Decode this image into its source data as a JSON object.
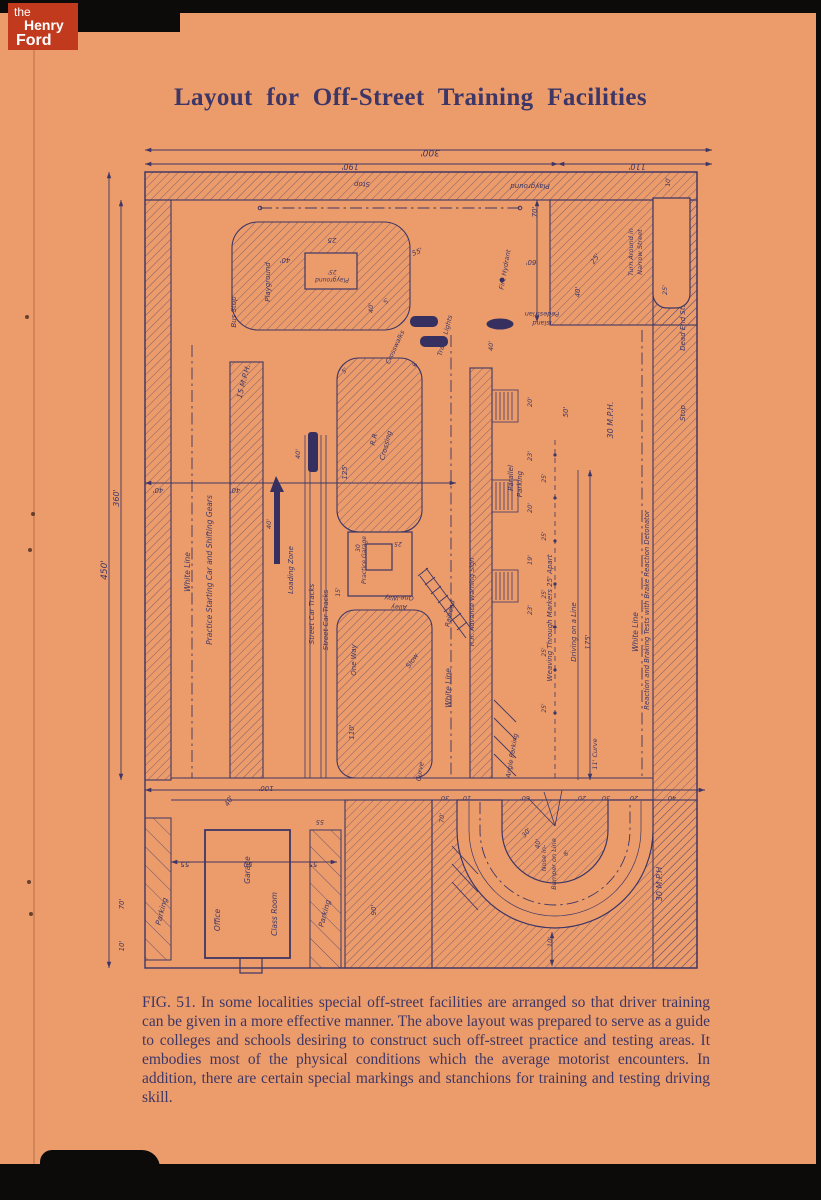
{
  "colors": {
    "paper": "#ec9c6a",
    "ink": "#3d3666",
    "logo_red": "#c23a1e",
    "frame": "#0c0b09"
  },
  "logo": {
    "line1": "the",
    "line2": "Henry",
    "line3": "Ford"
  },
  "title": "Layout for Off-Street Training Facilities",
  "caption": "FIG. 51. In some localities special off-street facilities are arranged so that driver training can be given in a more effective manner.  The above layout was prepared to serve as a guide to colleges and schools desiring to construct such off-street practice and testing areas.  It embodies most of the physical conditions which the average motorist encounters.  In addition, there are certain special markings and stanchions for training and testing driving skill.",
  "diagram": {
    "description": "Blueprint site plan of an off-street driver training facility",
    "labels": [
      {
        "t": "300'",
        "x": 330,
        "y": 10,
        "r": 180,
        "s": 9
      },
      {
        "t": "190'",
        "x": 250,
        "y": 24,
        "r": 180,
        "s": 8
      },
      {
        "t": "110'",
        "x": 537,
        "y": 24,
        "r": 180,
        "s": 8
      },
      {
        "t": "450'",
        "x": 7,
        "y": 430,
        "r": -90,
        "s": 9
      },
      {
        "t": "360'",
        "x": 19,
        "y": 358,
        "r": -90,
        "s": 8
      },
      {
        "t": "Stop",
        "x": 262,
        "y": 42,
        "r": 180,
        "s": 7
      },
      {
        "t": "Playground",
        "x": 430,
        "y": 44,
        "r": 180,
        "s": 7
      },
      {
        "t": "Playground",
        "x": 170,
        "y": 142,
        "r": -90,
        "s": 7
      },
      {
        "t": "Playground",
        "x": 232,
        "y": 138,
        "r": 180,
        "s": 6
      },
      {
        "t": "25'",
        "x": 232,
        "y": 130,
        "r": 180,
        "s": 6
      },
      {
        "t": "25",
        "x": 232,
        "y": 98,
        "r": 180,
        "s": 7
      },
      {
        "t": "40'",
        "x": 185,
        "y": 118,
        "r": 180,
        "s": 7
      },
      {
        "t": "55'",
        "x": 318,
        "y": 114,
        "r": -20,
        "s": 7
      },
      {
        "t": "Bus Stop",
        "x": 136,
        "y": 172,
        "r": -90,
        "s": 7
      },
      {
        "t": "Turn Around in",
        "x": 533,
        "y": 112,
        "r": -90,
        "s": 6.5
      },
      {
        "t": "Narrow Street",
        "x": 542,
        "y": 112,
        "r": -90,
        "s": 6.5
      },
      {
        "t": "10'",
        "x": 570,
        "y": 42,
        "r": -90,
        "s": 6
      },
      {
        "t": "25'",
        "x": 567,
        "y": 150,
        "r": -90,
        "s": 6.5
      },
      {
        "t": "Dead End St.",
        "x": 585,
        "y": 188,
        "r": -90,
        "s": 7
      },
      {
        "t": "Stop",
        "x": 585,
        "y": 273,
        "r": -90,
        "s": 7
      },
      {
        "t": "70'",
        "x": 437,
        "y": 72,
        "r": -90,
        "s": 7
      },
      {
        "t": "60'",
        "x": 431,
        "y": 120,
        "r": 180,
        "s": 7
      },
      {
        "t": "25'",
        "x": 497,
        "y": 120,
        "r": -55,
        "s": 7
      },
      {
        "t": "Fire Hydrant",
        "x": 407,
        "y": 130,
        "r": -80,
        "s": 6.5
      },
      {
        "t": "Crosswalks",
        "x": 297,
        "y": 208,
        "r": -65,
        "s": 6.5
      },
      {
        "t": "Traffic Lights",
        "x": 347,
        "y": 196,
        "r": -75,
        "s": 6.5
      },
      {
        "t": "Pedestrian",
        "x": 442,
        "y": 172,
        "r": 180,
        "s": 6.5
      },
      {
        "t": "Island",
        "x": 442,
        "y": 181,
        "r": 180,
        "s": 6.5
      },
      {
        "t": "5'",
        "x": 288,
        "y": 162,
        "r": -60,
        "s": 6
      },
      {
        "t": "6'",
        "x": 317,
        "y": 224,
        "r": -90,
        "s": 6
      },
      {
        "t": "40'",
        "x": 273,
        "y": 168,
        "r": -90,
        "s": 6.5
      },
      {
        "t": "40'",
        "x": 393,
        "y": 206,
        "r": -90,
        "s": 6.5
      },
      {
        "t": "15 M.P.H.",
        "x": 146,
        "y": 242,
        "r": -75,
        "s": 7.5
      },
      {
        "t": "White Line",
        "x": 90,
        "y": 432,
        "r": -90,
        "s": 7.5
      },
      {
        "t": "Practice Starting Car and Shifting Gears",
        "x": 112,
        "y": 430,
        "r": -90,
        "s": 7.5
      },
      {
        "t": "Loading Zone",
        "x": 193,
        "y": 430,
        "r": -90,
        "s": 7
      },
      {
        "t": "Street Car Tracks",
        "x": 214,
        "y": 474,
        "r": -90,
        "s": 7
      },
      {
        "t": "Street Car Tracks",
        "x": 228,
        "y": 480,
        "r": -90,
        "s": 7
      },
      {
        "t": "40'",
        "x": 200,
        "y": 314,
        "r": -90,
        "s": 6.5
      },
      {
        "t": "40'",
        "x": 171,
        "y": 384,
        "r": -90,
        "s": 6.5
      },
      {
        "t": "40'",
        "x": 58,
        "y": 348,
        "r": 180,
        "s": 7
      },
      {
        "t": "40'",
        "x": 135,
        "y": 348,
        "r": 180,
        "s": 7
      },
      {
        "t": "R.R",
        "x": 276,
        "y": 300,
        "r": -75,
        "s": 7
      },
      {
        "t": "Crossing",
        "x": 288,
        "y": 306,
        "r": -75,
        "s": 7
      },
      {
        "t": "125'",
        "x": 247,
        "y": 332,
        "r": -90,
        "s": 7
      },
      {
        "t": "5'",
        "x": 246,
        "y": 232,
        "r": -45,
        "s": 6
      },
      {
        "t": "Practice Garage",
        "x": 266,
        "y": 420,
        "r": -90,
        "s": 6
      },
      {
        "t": "25",
        "x": 298,
        "y": 402,
        "r": 180,
        "s": 6
      },
      {
        "t": "30",
        "x": 260,
        "y": 408,
        "r": -90,
        "s": 6
      },
      {
        "t": "15'",
        "x": 240,
        "y": 452,
        "r": -90,
        "s": 6
      },
      {
        "t": "One-Way",
        "x": 299,
        "y": 456,
        "r": 180,
        "s": 6.5
      },
      {
        "t": "Alley",
        "x": 299,
        "y": 465,
        "r": 180,
        "s": 6.5
      },
      {
        "t": "One Way",
        "x": 256,
        "y": 520,
        "r": -90,
        "s": 7
      },
      {
        "t": "Slow",
        "x": 314,
        "y": 522,
        "r": -55,
        "s": 7
      },
      {
        "t": "110'",
        "x": 254,
        "y": 592,
        "r": -90,
        "s": 7
      },
      {
        "t": "White Line",
        "x": 351,
        "y": 548,
        "r": -90,
        "s": 7.5
      },
      {
        "t": "Curve",
        "x": 322,
        "y": 632,
        "r": -80,
        "s": 6.5
      },
      {
        "t": "90'",
        "x": 276,
        "y": 770,
        "r": -90,
        "s": 7
      },
      {
        "t": "Parking",
        "x": 64,
        "y": 772,
        "r": -75,
        "s": 7.5
      },
      {
        "t": "Parking",
        "x": 227,
        "y": 774,
        "r": -75,
        "s": 7.5
      },
      {
        "t": "Railroad",
        "x": 352,
        "y": 474,
        "r": -78,
        "s": 6.5
      },
      {
        "t": "R.R. Advance Warning Sign",
        "x": 374,
        "y": 462,
        "r": -90,
        "s": 6.5
      },
      {
        "t": "Parallel",
        "x": 413,
        "y": 338,
        "r": -90,
        "s": 7
      },
      {
        "t": "Parking",
        "x": 422,
        "y": 344,
        "r": -90,
        "s": 7
      },
      {
        "t": "20'",
        "x": 432,
        "y": 262,
        "r": -90,
        "s": 6.5
      },
      {
        "t": "23'",
        "x": 432,
        "y": 316,
        "r": -90,
        "s": 6.5
      },
      {
        "t": "20'",
        "x": 432,
        "y": 368,
        "r": -90,
        "s": 6.5
      },
      {
        "t": "19'",
        "x": 432,
        "y": 420,
        "r": -90,
        "s": 6.5
      },
      {
        "t": "23'",
        "x": 432,
        "y": 470,
        "r": -90,
        "s": 6.5
      },
      {
        "t": "Weaving Through Markers 25' Apart",
        "x": 452,
        "y": 478,
        "r": -90,
        "s": 7
      },
      {
        "t": "Driving on a Line",
        "x": 476,
        "y": 492,
        "r": -90,
        "s": 7
      },
      {
        "t": "175'",
        "x": 490,
        "y": 502,
        "r": -90,
        "s": 7
      },
      {
        "t": "50'",
        "x": 468,
        "y": 272,
        "r": -90,
        "s": 7
      },
      {
        "t": "40'",
        "x": 480,
        "y": 152,
        "r": -90,
        "s": 7
      },
      {
        "t": "25'",
        "x": 446,
        "y": 338,
        "r": -90,
        "s": 6
      },
      {
        "t": "25'",
        "x": 446,
        "y": 396,
        "r": -90,
        "s": 6
      },
      {
        "t": "25'",
        "x": 446,
        "y": 454,
        "r": -90,
        "s": 6
      },
      {
        "t": "25'",
        "x": 446,
        "y": 512,
        "r": -90,
        "s": 6
      },
      {
        "t": "25'",
        "x": 446,
        "y": 568,
        "r": -90,
        "s": 6
      },
      {
        "t": "30 M.P.H.",
        "x": 513,
        "y": 280,
        "r": -90,
        "s": 8
      },
      {
        "t": "White Line",
        "x": 538,
        "y": 492,
        "r": -90,
        "s": 7.5
      },
      {
        "t": "Reaction and Braking Tests with Brake Reaction Detonator",
        "x": 549,
        "y": 470,
        "r": -90,
        "s": 6.8
      },
      {
        "t": "30 M.P.H",
        "x": 562,
        "y": 744,
        "r": -90,
        "s": 8
      },
      {
        "t": "11' Curve",
        "x": 497,
        "y": 614,
        "r": -90,
        "s": 6.5
      },
      {
        "t": "Nose in-",
        "x": 446,
        "y": 718,
        "r": -90,
        "s": 6.5
      },
      {
        "t": "Bumper on Line",
        "x": 456,
        "y": 724,
        "r": -90,
        "s": 6.5
      },
      {
        "t": "Angle Parking",
        "x": 414,
        "y": 616,
        "r": -80,
        "s": 6.5
      },
      {
        "t": "30'",
        "x": 428,
        "y": 694,
        "r": -50,
        "s": 6.5
      },
      {
        "t": "40'",
        "x": 440,
        "y": 704,
        "r": -85,
        "s": 6.5
      },
      {
        "t": "8'",
        "x": 468,
        "y": 714,
        "r": -60,
        "s": 6
      },
      {
        "t": "10'",
        "x": 452,
        "y": 802,
        "r": -90,
        "s": 6.5
      },
      {
        "t": "70'",
        "x": 344,
        "y": 678,
        "r": -90,
        "s": 6.5
      },
      {
        "t": "100'",
        "x": 166,
        "y": 646,
        "r": 180,
        "s": 7
      },
      {
        "t": "30",
        "x": 345,
        "y": 656,
        "r": 180,
        "s": 6.5
      },
      {
        "t": "10",
        "x": 367,
        "y": 656,
        "r": 180,
        "s": 6.5
      },
      {
        "t": "60'",
        "x": 425,
        "y": 656,
        "r": 180,
        "s": 6.5
      },
      {
        "t": "20",
        "x": 482,
        "y": 656,
        "r": 180,
        "s": 6.5
      },
      {
        "t": "30",
        "x": 506,
        "y": 656,
        "r": 180,
        "s": 6.5
      },
      {
        "t": "20",
        "x": 534,
        "y": 656,
        "r": 180,
        "s": 6.5
      },
      {
        "t": "40",
        "x": 572,
        "y": 656,
        "r": 180,
        "s": 6.5
      },
      {
        "t": "55",
        "x": 220,
        "y": 680,
        "r": 180,
        "s": 6.5
      },
      {
        "t": "Office",
        "x": 120,
        "y": 780,
        "r": -90,
        "s": 7.5
      },
      {
        "t": "Garage",
        "x": 150,
        "y": 730,
        "r": -90,
        "s": 7.5
      },
      {
        "t": "Class Room",
        "x": 177,
        "y": 774,
        "r": -90,
        "s": 7.5
      },
      {
        "t": "55",
        "x": 85,
        "y": 722,
        "r": 180,
        "s": 7
      },
      {
        "t": "50",
        "x": 148,
        "y": 722,
        "r": 180,
        "s": 7
      },
      {
        "t": "55",
        "x": 213,
        "y": 722,
        "r": 180,
        "s": 7
      },
      {
        "t": "40'",
        "x": 131,
        "y": 662,
        "r": -60,
        "s": 7
      },
      {
        "t": "70'",
        "x": 24,
        "y": 764,
        "r": -90,
        "s": 7
      },
      {
        "t": "10'",
        "x": 24,
        "y": 806,
        "r": -90,
        "s": 7
      }
    ]
  }
}
